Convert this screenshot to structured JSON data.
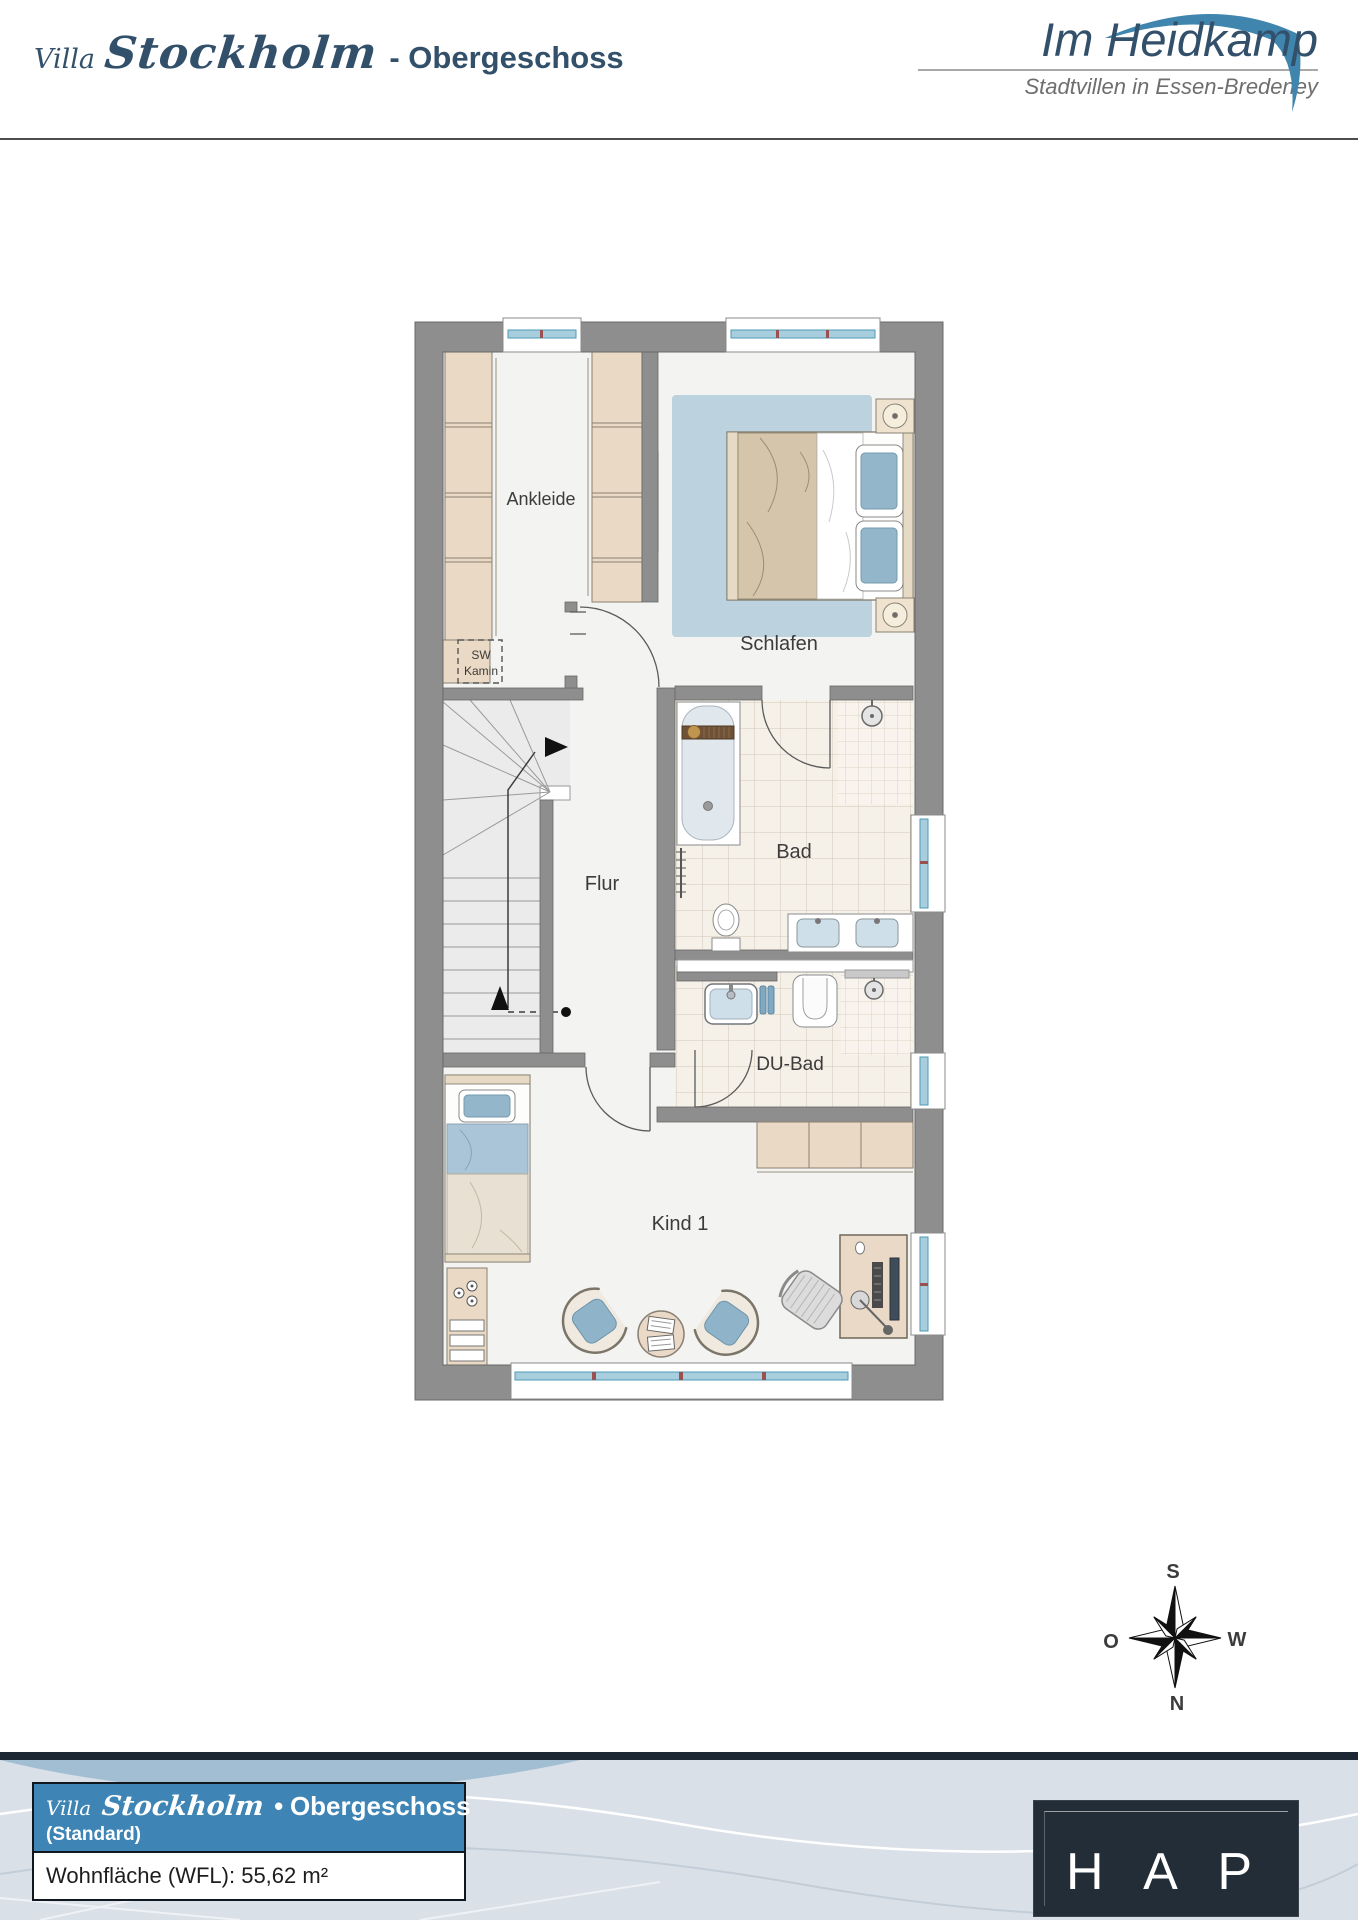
{
  "header": {
    "title_villa": "Villa",
    "title_name": "Stockholm",
    "title_floor": "- Obergeschoss",
    "brand_name": "Im Heidkamp",
    "brand_tagline": "Stadtvillen in Essen-Bredeney"
  },
  "plan": {
    "rooms": {
      "ankleide": "Ankleide",
      "schlafen": "Schlafen",
      "bad": "Bad",
      "flur": "Flur",
      "du_bad": "DU-Bad",
      "kind1": "Kind 1"
    },
    "kamin": {
      "line1": "SW",
      "line2": "Kamin"
    }
  },
  "compass": {
    "top": "S",
    "right": "W",
    "bottom": "N",
    "left": "O"
  },
  "footer": {
    "villa": "Villa",
    "name": "Stockholm",
    "bullet": "•",
    "floor": "Obergeschoss",
    "variant": "(Standard)",
    "area": "Wohnfläche (WFL): 55,62 m²",
    "logo": "H A P"
  },
  "colors": {
    "accent_blue": "#3e85b5",
    "navy_text": "#33506b",
    "wall_gray": "#8e8e8e",
    "window_blue": "#4d9ab8",
    "rug_blue": "#bdd2df",
    "furniture_beige": "#ead9c4",
    "logo_swoosh": "#3f85ad",
    "dark_panel": "#232d38"
  }
}
